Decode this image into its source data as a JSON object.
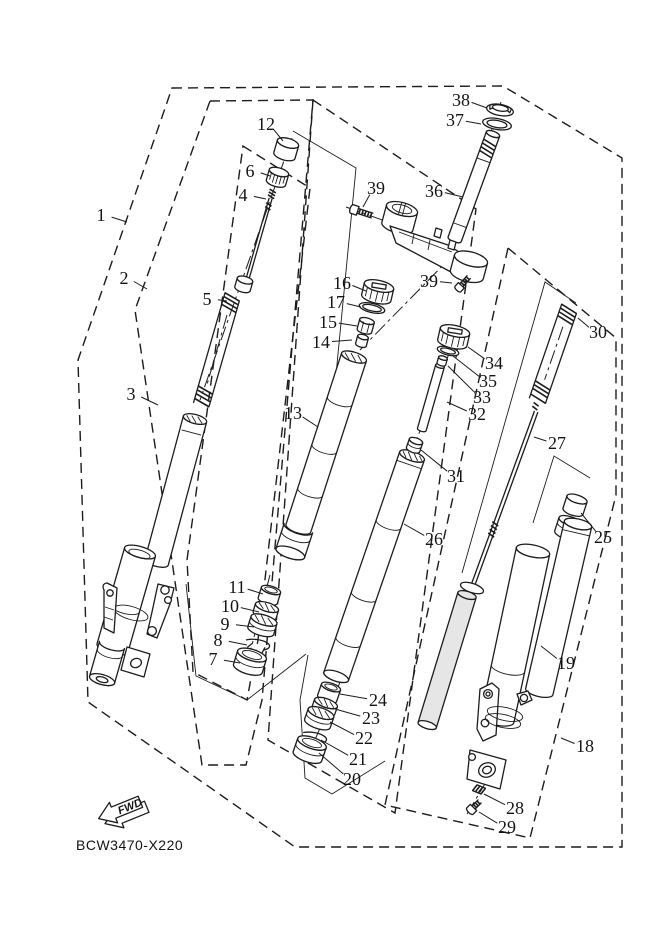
{
  "diagram": {
    "part_code": "BCW3470-X220",
    "fwd_label": "FWD",
    "background_color": "#ffffff",
    "line_color": "#1c1c1c",
    "type": "exploded-parts-diagram",
    "subject": "front-fork-assembly"
  },
  "callouts": [
    {
      "n": "1",
      "x": 101,
      "y": 215,
      "tx": 127,
      "ty": 222
    },
    {
      "n": "2",
      "x": 124,
      "y": 278,
      "tx": 147,
      "ty": 289
    },
    {
      "n": "3",
      "x": 131,
      "y": 394,
      "tx": 158,
      "ty": 405
    },
    {
      "n": "4",
      "x": 243,
      "y": 195,
      "tx": 266,
      "ty": 199
    },
    {
      "n": "5",
      "x": 207,
      "y": 299,
      "tx": 227,
      "ty": 301
    },
    {
      "n": "6",
      "x": 250,
      "y": 171,
      "tx": 270,
      "ty": 176
    },
    {
      "n": "7",
      "x": 213,
      "y": 659,
      "tx": 240,
      "ty": 663
    },
    {
      "n": "8",
      "x": 218,
      "y": 640,
      "tx": 247,
      "ty": 645
    },
    {
      "n": "9",
      "x": 225,
      "y": 624,
      "tx": 254,
      "ty": 627
    },
    {
      "n": "10",
      "x": 230,
      "y": 606,
      "tx": 259,
      "ty": 612
    },
    {
      "n": "11",
      "x": 237,
      "y": 587,
      "tx": 263,
      "ty": 594
    },
    {
      "n": "12",
      "x": 266,
      "y": 124,
      "tx": 283,
      "ty": 141
    },
    {
      "n": "13",
      "x": 293,
      "y": 413,
      "tx": 318,
      "ty": 427
    },
    {
      "n": "14",
      "x": 321,
      "y": 342,
      "tx": 352,
      "ty": 340
    },
    {
      "n": "15",
      "x": 328,
      "y": 322,
      "tx": 357,
      "ty": 326
    },
    {
      "n": "16",
      "x": 342,
      "y": 283,
      "tx": 366,
      "ty": 291
    },
    {
      "n": "17",
      "x": 336,
      "y": 302,
      "tx": 361,
      "ty": 307
    },
    {
      "n": "18",
      "x": 585,
      "y": 746,
      "tx": 561,
      "ty": 738
    },
    {
      "n": "19",
      "x": 566,
      "y": 663,
      "tx": 541,
      "ty": 646
    },
    {
      "n": "20",
      "x": 352,
      "y": 779,
      "tx": 319,
      "ty": 753
    },
    {
      "n": "21",
      "x": 358,
      "y": 759,
      "tx": 321,
      "ty": 740
    },
    {
      "n": "22",
      "x": 364,
      "y": 738,
      "tx": 330,
      "ty": 722
    },
    {
      "n": "23",
      "x": 371,
      "y": 718,
      "tx": 335,
      "ty": 709
    },
    {
      "n": "24",
      "x": 378,
      "y": 700,
      "tx": 340,
      "ty": 694
    },
    {
      "n": "25",
      "x": 603,
      "y": 537,
      "tx": 581,
      "ty": 513
    },
    {
      "n": "26",
      "x": 434,
      "y": 539,
      "tx": 404,
      "ty": 524
    },
    {
      "n": "27",
      "x": 557,
      "y": 443,
      "tx": 534,
      "ty": 437
    },
    {
      "n": "28",
      "x": 515,
      "y": 808,
      "tx": 484,
      "ty": 794
    },
    {
      "n": "29",
      "x": 507,
      "y": 827,
      "tx": 479,
      "ty": 812
    },
    {
      "n": "30",
      "x": 598,
      "y": 332,
      "tx": 578,
      "ty": 318
    },
    {
      "n": "31",
      "x": 456,
      "y": 476,
      "tx": 421,
      "ty": 450
    },
    {
      "n": "32",
      "x": 477,
      "y": 414,
      "tx": 447,
      "ty": 402
    },
    {
      "n": "33",
      "x": 482,
      "y": 397,
      "tx": 448,
      "ty": 366
    },
    {
      "n": "34",
      "x": 494,
      "y": 363,
      "tx": 468,
      "ty": 347
    },
    {
      "n": "35",
      "x": 488,
      "y": 381,
      "tx": 453,
      "ty": 356
    },
    {
      "n": "36",
      "x": 434,
      "y": 191,
      "tx": 463,
      "ty": 197
    },
    {
      "n": "37",
      "x": 455,
      "y": 120,
      "tx": 481,
      "ty": 124
    },
    {
      "n": "38",
      "x": 461,
      "y": 100,
      "tx": 487,
      "ty": 108
    },
    {
      "n": "39",
      "x": 376,
      "y": 188,
      "tx": 363,
      "ty": 207
    },
    {
      "n": "39",
      "x": 429,
      "y": 281,
      "tx": 452,
      "ty": 283
    }
  ]
}
